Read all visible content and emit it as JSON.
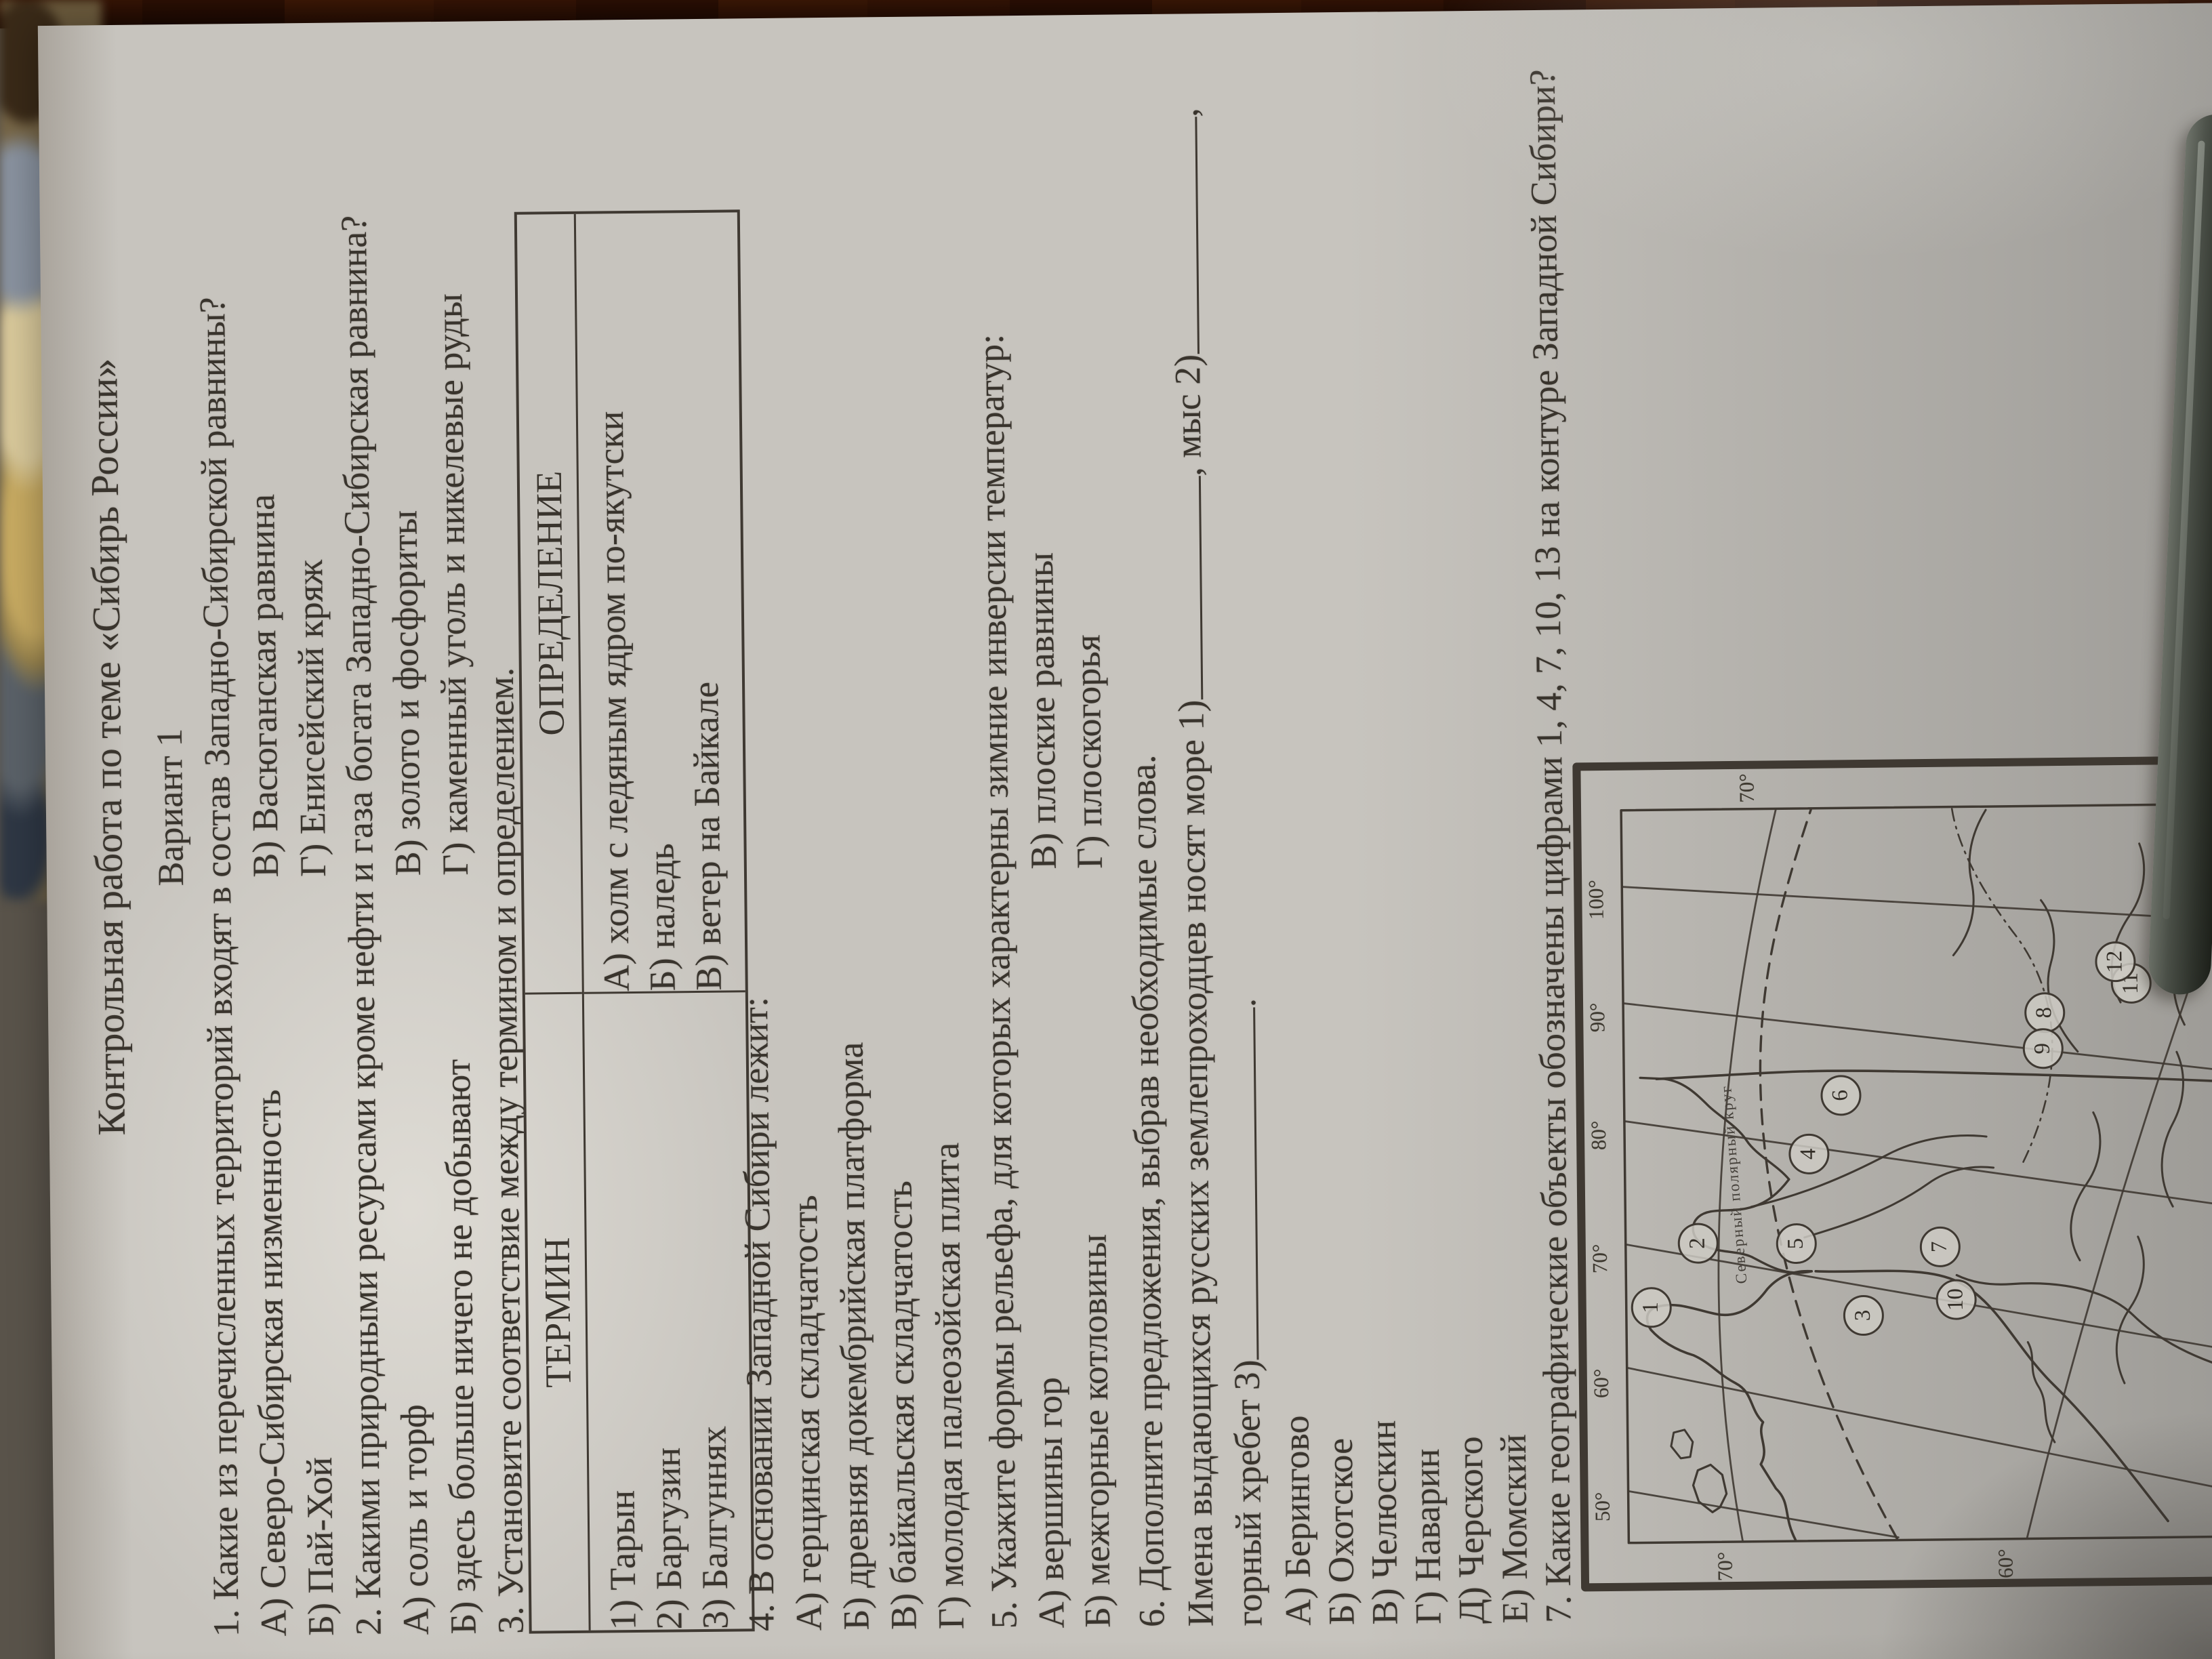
{
  "document": {
    "title": "Контрольная работа по теме «Сибирь России»",
    "variant": "Вариант 1",
    "q1": {
      "text": "1. Какие из перечисленных территорий входят в состав Западно-Сибирской равнины?",
      "options": [
        [
          "А) Северо-Сибирская низменность",
          "В) Васюганская равнина"
        ],
        [
          "Б) Пай-Хой",
          "Г) Енисейский кряж"
        ]
      ]
    },
    "q2": {
      "text": "2. Какими природными ресурсами кроме нефти и газа богата Западно-Сибирская равнина?",
      "options": [
        [
          "А) соль и торф",
          "В) золото и фосфориты"
        ],
        [
          "Б) здесь больше ничего не добывают",
          "Г) каменный уголь и никелевые руды"
        ]
      ]
    },
    "q3": {
      "text": "3. Установите соответствие между термином и определением.",
      "table": {
        "headers": [
          "ТЕРМИН",
          "ОПРЕДЕЛЕНИЕ"
        ],
        "terms": [
          "1)  Тарын",
          "2)  Баргузин",
          "3)  Балгуннях"
        ],
        "definitions": [
          "А) холм с ледяным ядром по-якутски",
          "Б) наледь",
          "В) ветер на Байкале"
        ]
      }
    },
    "q4": {
      "text": "4. В основании Западной Сибири лежит:",
      "options": [
        "А) герцинская складчатость",
        "Б) древняя докембрийская платформа",
        "В) байкальская складчатость",
        "Г) молодая палеозойская плита"
      ]
    },
    "q5": {
      "text": "5. Укажите формы рельефа, для которых характерны зимние инверсии температур:",
      "options": [
        [
          "А) вершины гор",
          "В) плоские равнины"
        ],
        [
          "Б) межгорные котловины",
          "Г) плоскогорья"
        ]
      ]
    },
    "q6": {
      "text": "6. Дополните предложения, выбрав необходимые слова.",
      "fill_line1_before": "Имена выдающихся русских землепроходцев носят море 1)",
      "fill_line1_mid": ", мыс 2)",
      "fill_line1_end": ",",
      "fill_line2_before": "горный хребет 3)",
      "fill_line2_end": ".",
      "options": [
        "А) Берингово",
        "Б) Охотское",
        "В) Челюскин",
        "Г) Наварин",
        "Д) Черского",
        "Е) Момский"
      ]
    },
    "q7": {
      "text": "7. Какие географические объекты обозначены цифрами 1, 4, 7, 10, 13 на контуре Западной Сибири?"
    },
    "map": {
      "lon_labels": [
        "50°",
        "60°",
        "70°",
        "80°",
        "90°",
        "100°"
      ],
      "lat_labels_left": [
        "70°",
        "60°"
      ],
      "lat_labels_right": [
        "70°",
        "60°"
      ],
      "arctic_circle_label": "Северный полярный круг",
      "numbers": [
        "1",
        "2",
        "3",
        "4",
        "5",
        "6",
        "7",
        "8",
        "9",
        "10",
        "11",
        "12",
        "13"
      ]
    }
  }
}
